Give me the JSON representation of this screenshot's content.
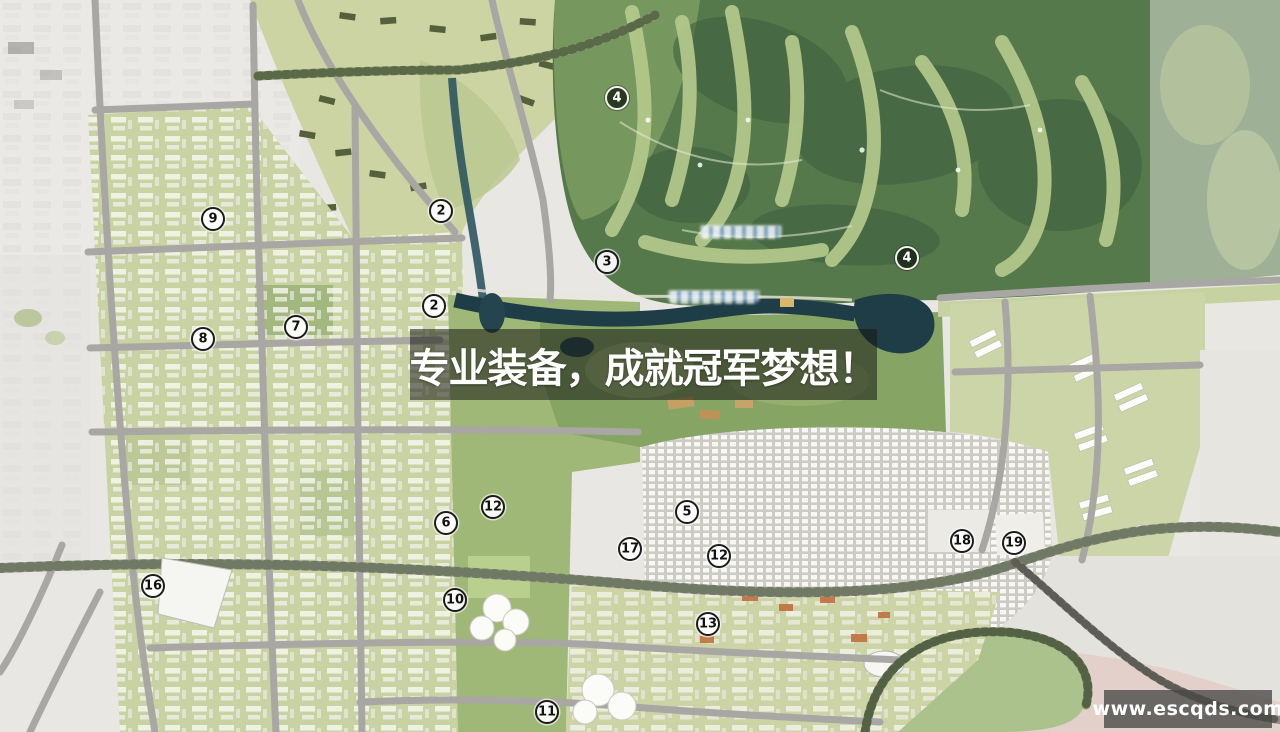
{
  "banner": {
    "text": "专业装备，成就冠军梦想！",
    "bg_color": "rgba(22,24,18,0.55)",
    "text_color": "#ffffff"
  },
  "watermark": {
    "text": "www.escqds.com",
    "bg_color": "rgba(72,72,70,0.78)",
    "text_color": "#ffffff"
  },
  "map": {
    "type": "urban-master-plan-aerial-rendering",
    "colors": {
      "forest": "#55794b",
      "golf_fairway": "#b6cb8d",
      "water": "#1f3d47",
      "urban_block_green": "#c9d2a2",
      "road_gray": "#a8a7a3",
      "dense_urban": "#d5d4cc",
      "pink_zone": "#e3cdc8",
      "paper": "#e8e7e3"
    },
    "markers": [
      {
        "label": "4",
        "variant": "dark"
      },
      {
        "label": "2",
        "variant": "light"
      },
      {
        "label": "9",
        "variant": "light"
      },
      {
        "label": "3",
        "variant": "light"
      },
      {
        "label": "4",
        "variant": "dark"
      },
      {
        "label": "2",
        "variant": "light"
      },
      {
        "label": "7",
        "variant": "light"
      },
      {
        "label": "8",
        "variant": "light"
      },
      {
        "label": "12",
        "variant": "light"
      },
      {
        "label": "5",
        "variant": "light"
      },
      {
        "label": "6",
        "variant": "light"
      },
      {
        "label": "17",
        "variant": "light"
      },
      {
        "label": "12",
        "variant": "light"
      },
      {
        "label": "18",
        "variant": "light"
      },
      {
        "label": "19",
        "variant": "light"
      },
      {
        "label": "16",
        "variant": "light"
      },
      {
        "label": "10",
        "variant": "light"
      },
      {
        "label": "13",
        "variant": "light"
      },
      {
        "label": "11",
        "variant": "light"
      }
    ]
  }
}
